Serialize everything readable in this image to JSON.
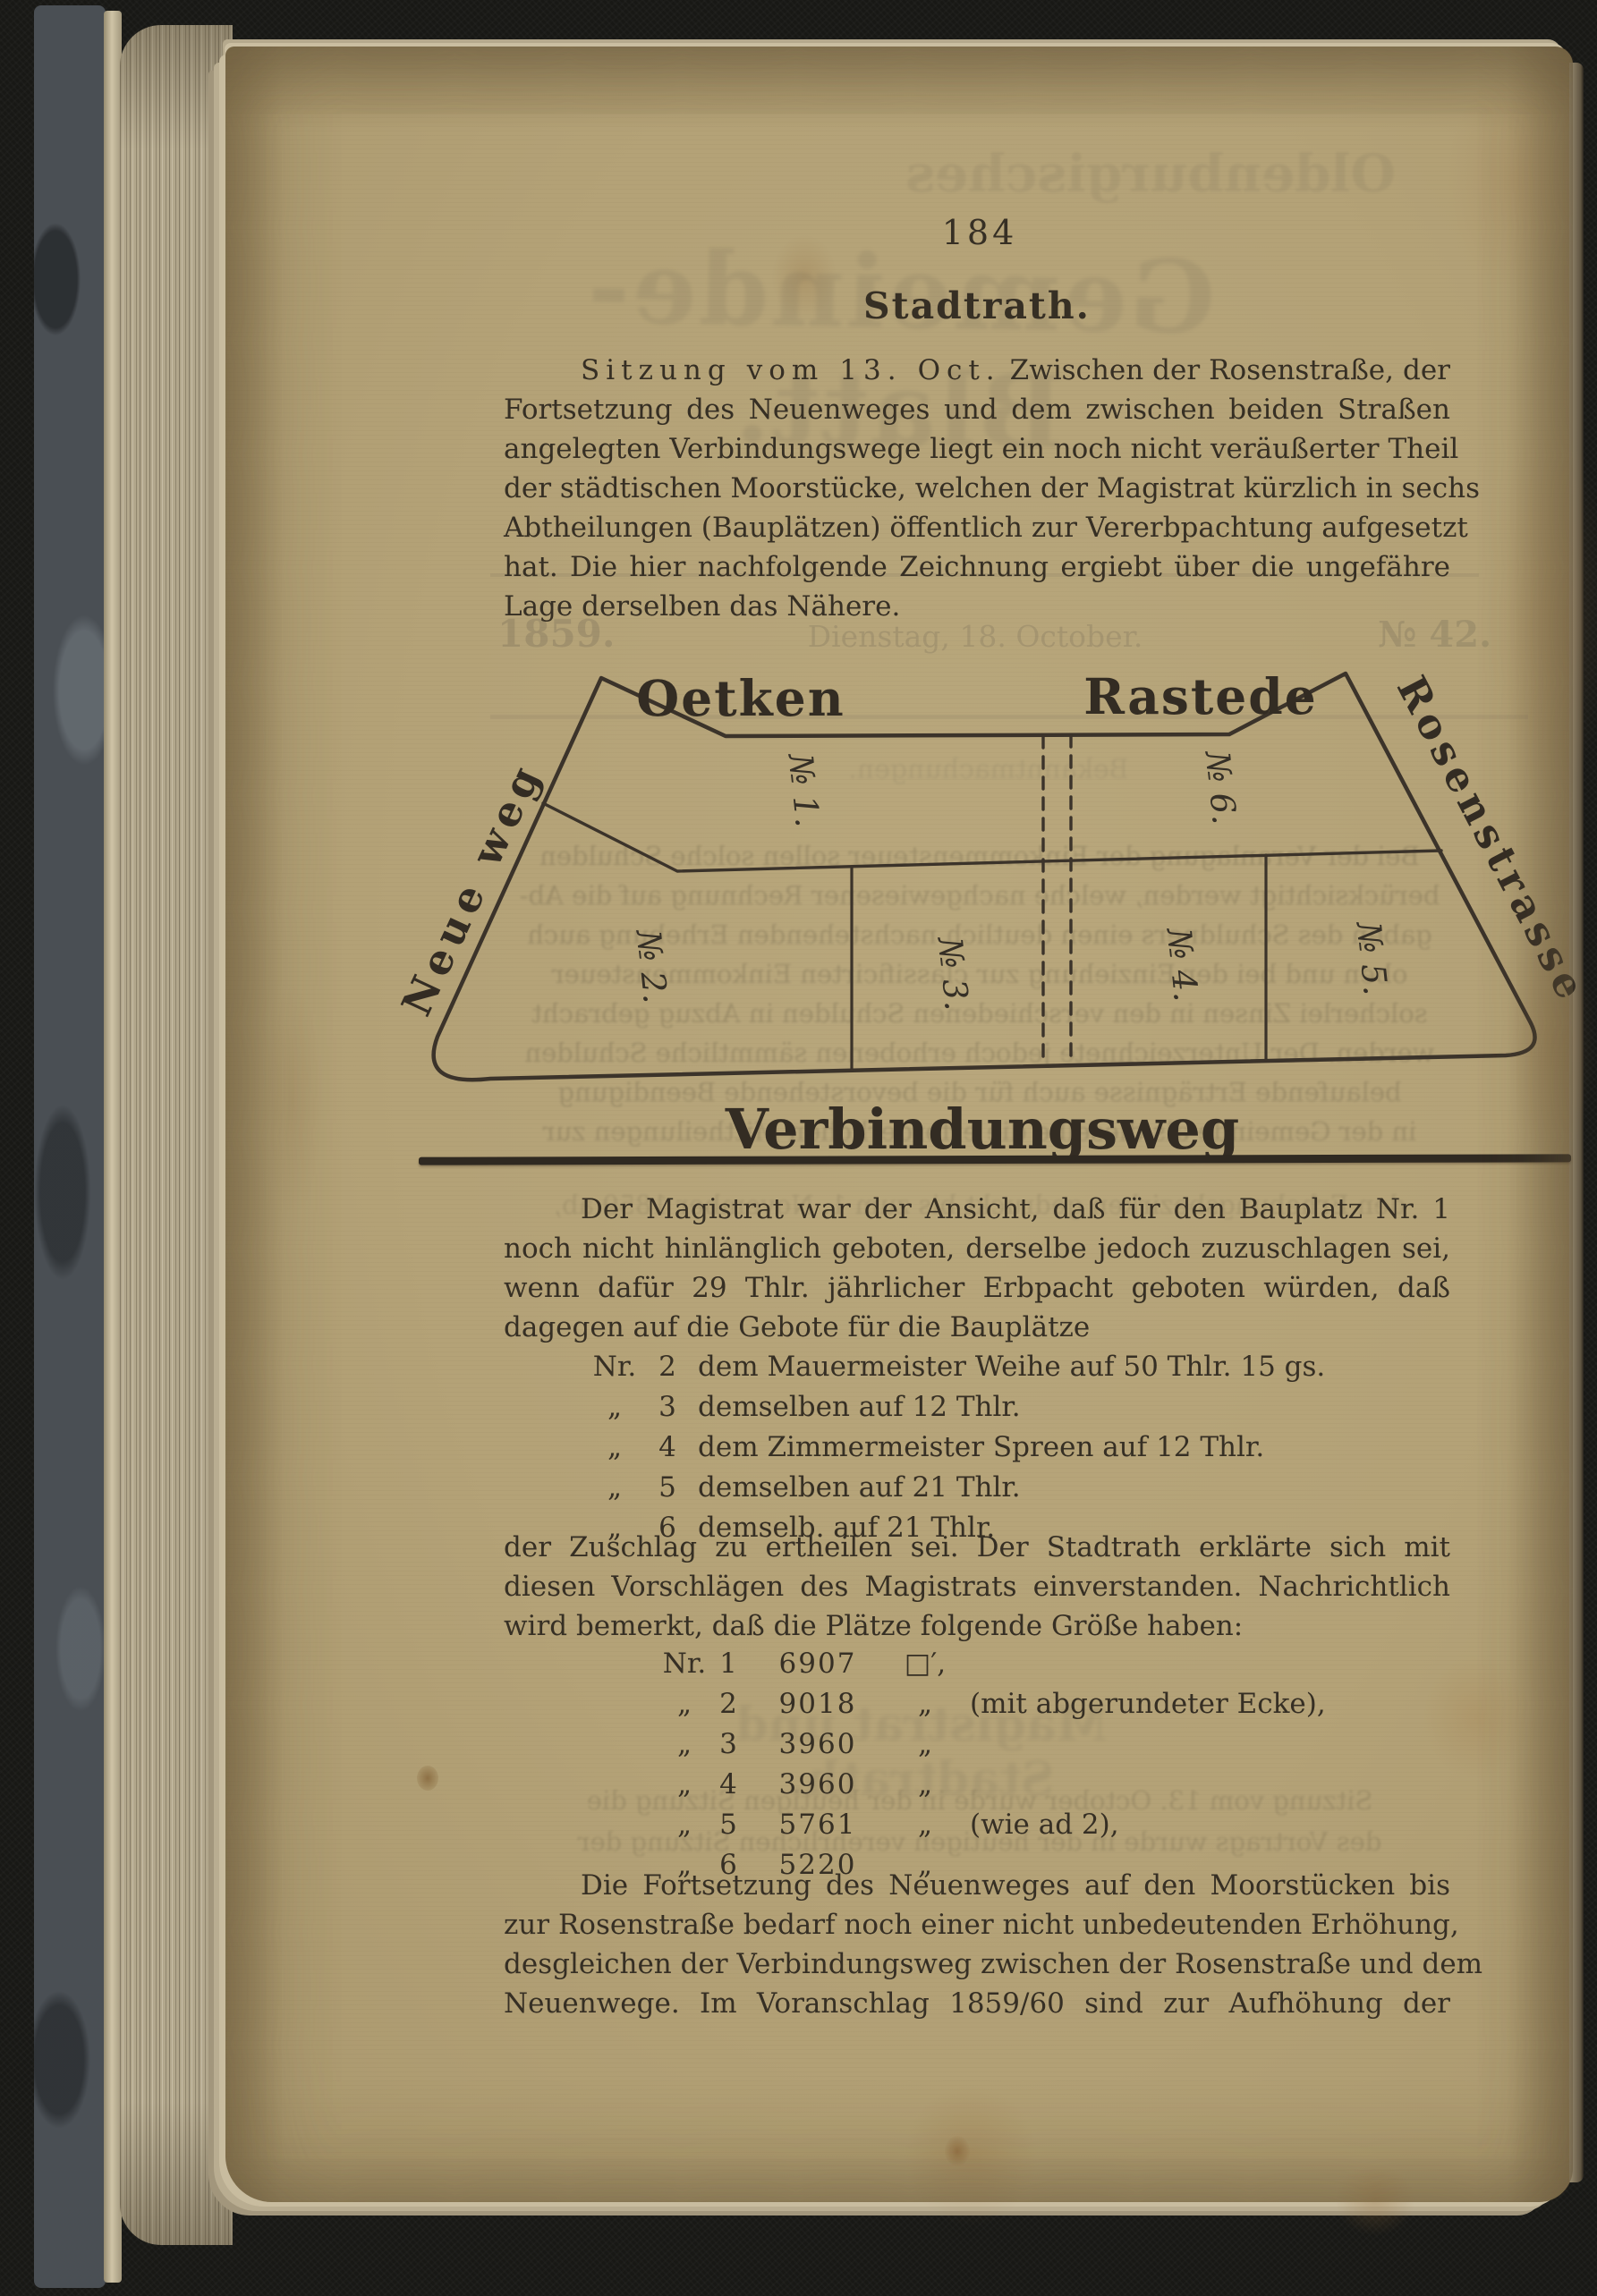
{
  "page_number": "184",
  "heading": "Stadtrath.",
  "para1": {
    "intro": "Sitzung vom 13. Oct.",
    "l1": "Zwischen der Rosenstraße, der",
    "l2": "Fortsetzung des Neuenweges und dem zwischen beiden Straßen",
    "l3": "angelegten Verbindungswege liegt ein noch nicht veräußerter Theil",
    "l4": "der städtischen Moorstücke, welchen der Magistrat kürzlich in sechs",
    "l5": "Abtheilungen (Bauplätzen) öffentlich zur Vererbpachtung aufgesetzt",
    "l6": "hat.  Die hier nachfolgende Zeichnung ergiebt über die ungefähre",
    "l7": "Lage derselben das Nähere."
  },
  "diagram": {
    "street_top_left": "Oetken",
    "street_top_right": "Rastede",
    "street_left": "Neue weg",
    "street_right": "Rosenstrasse",
    "street_bottom": "Verbindungsweg",
    "plots": [
      "№ 1.",
      "№ 2.",
      "№ 3.",
      "№ 4.",
      "№ 5.",
      "№ 6."
    ]
  },
  "para2": {
    "l1": "Der Magistrat war der Ansicht, daß für den Bauplatz Nr. 1",
    "l2": "noch nicht hinlänglich geboten, derselbe jedoch zuzuschlagen sei,",
    "l3": "wenn dafür 29 Thlr. jährlicher Erbpacht geboten würden, daß",
    "l4": "dagegen auf die Gebote für die Bauplätze"
  },
  "bids": {
    "rows": [
      {
        "mark": "Nr.",
        "num": "2",
        "text": "dem Mauermeister Weihe auf 50 Thlr. 15 gs."
      },
      {
        "mark": "„",
        "num": "3",
        "text": "demselben auf 12 Thlr."
      },
      {
        "mark": "„",
        "num": "4",
        "text": "dem Zimmermeister Spreen auf 12 Thlr."
      },
      {
        "mark": "„",
        "num": "5",
        "text": "demselben auf 21 Thlr."
      },
      {
        "mark": "„",
        "num": "6",
        "text": "demselb. auf 21 Thlr."
      }
    ]
  },
  "para3": {
    "l1": "der Zuschlag zu ertheilen sei.  Der Stadtrath erklärte sich mit",
    "l2": "diesen Vorschlägen des Magistrats einverstanden.  Nachrichtlich",
    "l3": "wird bemerkt, daß die Plätze folgende Größe haben:"
  },
  "sizes": {
    "rows": [
      {
        "mark": "Nr.",
        "num": "1",
        "value": "6907",
        "unit": "□′,",
        "suffix": ""
      },
      {
        "mark": "„",
        "num": "2",
        "value": "9018",
        "unit": "„",
        "suffix": "(mit abgerundeter Ecke),"
      },
      {
        "mark": "„",
        "num": "3",
        "value": "3960",
        "unit": "„",
        "suffix": ""
      },
      {
        "mark": "„",
        "num": "4",
        "value": "3960",
        "unit": "„",
        "suffix": ""
      },
      {
        "mark": "„",
        "num": "5",
        "value": "5761",
        "unit": "„",
        "suffix": "(wie ad 2),"
      },
      {
        "mark": "„",
        "num": "6",
        "value": "5220",
        "unit": "„",
        "suffix": ""
      }
    ]
  },
  "para4": {
    "l1": "Die Fortsetzung des Neuenweges  auf den Moorstücken bis",
    "l2": "zur Rosenstraße bedarf noch  einer nicht unbedeutenden Erhöhung,",
    "l3": "desgleichen der Verbindungsweg zwischen der Rosenstraße und dem",
    "l4": "Neuenwege.  Im Voranschlag 1859/60 sind zur Aufhöhung der"
  },
  "bleedthrough": {
    "masthead_top": "Oldenburgisches",
    "masthead_large": "Gemeinde-Blatt.",
    "dateline_year": "1859.",
    "dateline_date": "Dienstag, 18. October.",
    "dateline_issue": "№ 42.",
    "section_heading": "Bekanntmachungen.",
    "verso_heading": "Magistrat und Stadtrath.",
    "diagram_lines": [
      "Bei der Veranlagung der Einkommensteuer sollen solche Schulden",
      "berücksichtigt werden, welche nachgewiesener Rechnung auf die Ab-",
      "gaben des Schuldners einen deutlich nachstehenden Erhebung auch",
      "oben und bei der Einziehung zur classificirten Einkommensteuer",
      "solcherlei Zinsen in den verschiedenen Schulden in Abzug gebracht",
      "werden.  Der Unterzeichnete jedoch erhobenen sämmtliche Schulden",
      "belaufende Erträgnisse auch für die bevorstehende Beendigung",
      "in der Gemeinde als dieselbe die erforderlichen Mittheilungen zur",
      "den Erhebungsbezirken gedruckt bis zum 1. November 1859 ab,"
    ],
    "list_lines": [
      "Sitzung vom 13. October wurde in der heutigen Sitzung die",
      "des Vortrags wurde in der heutigen verehrlichen Sitzung der"
    ]
  },
  "colors": {
    "paper": "#d6cbae",
    "ink": "#362f24",
    "diagram_line": "#3b332a",
    "ghost": "#6e6552",
    "background": "#181815"
  }
}
